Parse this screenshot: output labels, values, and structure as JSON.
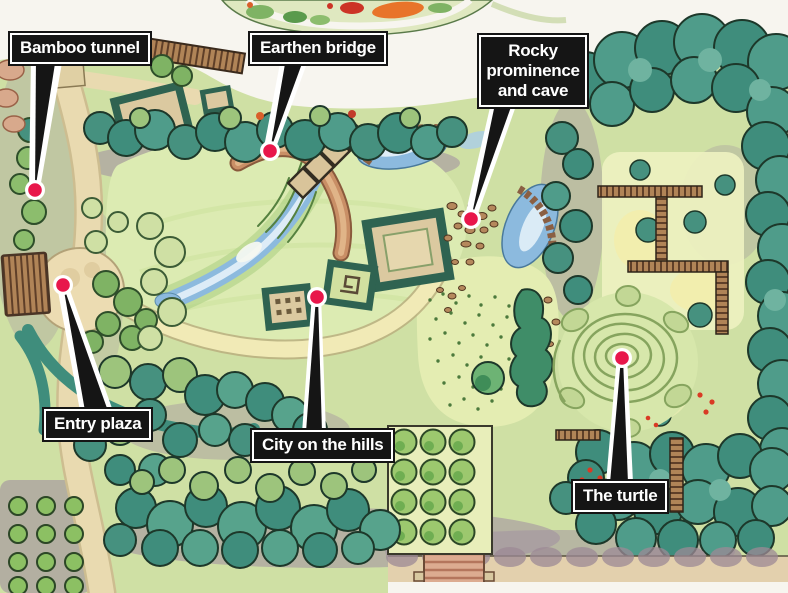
{
  "title": "Illustrated garden master plan",
  "callouts": [
    {
      "id": "bamboo-tunnel",
      "label": "Bamboo tunnel"
    },
    {
      "id": "earthen-bridge",
      "label": "Earthen bridge"
    },
    {
      "id": "rocky-prominence-and-cave",
      "label": "Rocky prominence and cave"
    },
    {
      "id": "entry-plaza",
      "label": "Entry plaza"
    },
    {
      "id": "city-on-the-hills",
      "label": "City on the hills"
    },
    {
      "id": "the-turtle",
      "label": "The turtle"
    }
  ],
  "marker": {
    "fill": "#e8174b",
    "ring": "#ffffff"
  },
  "label_style": {
    "background": "#151515",
    "text": "#ffffff",
    "border": "#ffffff"
  },
  "map_features": [
    "lawn",
    "stream",
    "earthen-bridge",
    "trellis-bridge",
    "hill-pavilions",
    "ponds",
    "stepping-stone-bridges",
    "rock-scatter",
    "meadow",
    "turtle-mound",
    "pergola-walks",
    "orchard-grids",
    "entry-plaza",
    "bamboo-path",
    "tree-canopy",
    "flower-border-arc"
  ],
  "map_palette": {
    "background": "#f7f5ef",
    "garden_base": "#cfe0a4",
    "lawn": "#dcebb2",
    "canopy_teal": "#3f8d7c",
    "canopy_light": "#9dc47c",
    "water": "#8cbade",
    "path_tan": "#e9dab0",
    "path_yellow": "#f1eab6",
    "earth_brick": "#c98f66",
    "shadow_mauve": "#a08da0"
  }
}
